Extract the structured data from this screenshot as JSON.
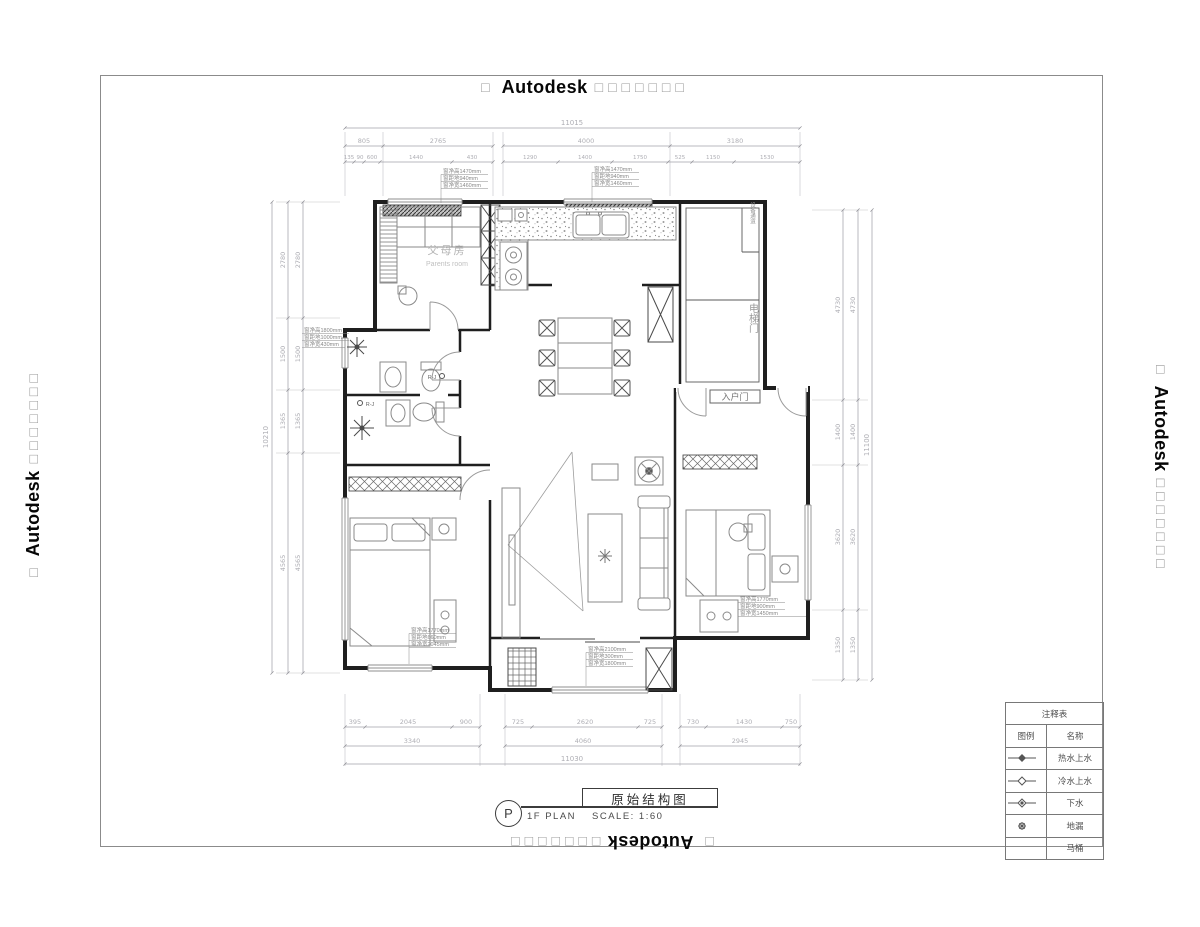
{
  "watermark": {
    "prefix": "□",
    "brand": "Autodesk",
    "suffix": "□□□□□□□"
  },
  "title_block": {
    "bubble": "P",
    "plan_label": "1F PLAN",
    "drawing_title": "原始结构图",
    "scale_label": "SCALE:  1:60"
  },
  "legend": {
    "header": "注释表",
    "col_symbol": "图例",
    "col_name": "名称",
    "rows": [
      {
        "icon": "hot-water-valve-icon",
        "label": "热水上水"
      },
      {
        "icon": "cold-water-valve-icon",
        "label": "冷水上水"
      },
      {
        "icon": "drain-valve-icon",
        "label": "下水"
      },
      {
        "icon": "floor-drain-icon",
        "label": "地漏"
      },
      {
        "icon": "none",
        "label": "马桶"
      }
    ]
  },
  "rooms": {
    "parents_cn": "父母房",
    "parents_en": "Parents room",
    "entry_door": "入户门",
    "elevator_door": "电梯门",
    "utility_shaft": "设备通道",
    "tap_label": "R-J"
  },
  "annotations": {
    "win_a": [
      "窗净高1470mm",
      "窗距地940mm",
      "窗净宽1460mm"
    ],
    "win_b": [
      "窗净高1470mm",
      "窗距地940mm",
      "窗净宽1460mm"
    ],
    "win_c": [
      "窗净高1800mm",
      "窗距地1000mm",
      "窗净宽430mm"
    ],
    "win_d": [
      "窗净高1770mm",
      "窗距地660mm",
      "窗净宽2045mm"
    ],
    "win_e": [
      "窗净高2100mm",
      "窗距地300mm",
      "窗净宽1800mm"
    ],
    "win_f": [
      "窗净高1770mm",
      "窗距地900mm",
      "窗净宽1450mm"
    ]
  },
  "dims": {
    "top_total": "11015",
    "top_row2": [
      "805",
      "2765",
      "4000",
      "3180"
    ],
    "top_row3": [
      "135",
      "90",
      "600",
      "1440",
      "430",
      "1290",
      "1400",
      "1750",
      "525",
      "1150",
      "1530"
    ],
    "left_total": "10210",
    "left_segs": [
      "2780",
      "1500",
      "1365",
      "4565"
    ],
    "right_total": "11100",
    "right_segs": [
      "4730",
      "1400",
      "3620",
      "1350"
    ],
    "bottom_row1": [
      "395",
      "2045",
      "900",
      "725",
      "2620",
      "725",
      "730",
      "1430",
      "750"
    ],
    "bottom_row2": [
      "3340",
      "4060",
      "2945"
    ],
    "bottom_total": "11030"
  },
  "colors": {
    "wall": "#1f1f1f",
    "dim": "#a2a2aa",
    "furniture": "#8a8a8a",
    "watermark_box": "#9b9b9b"
  }
}
